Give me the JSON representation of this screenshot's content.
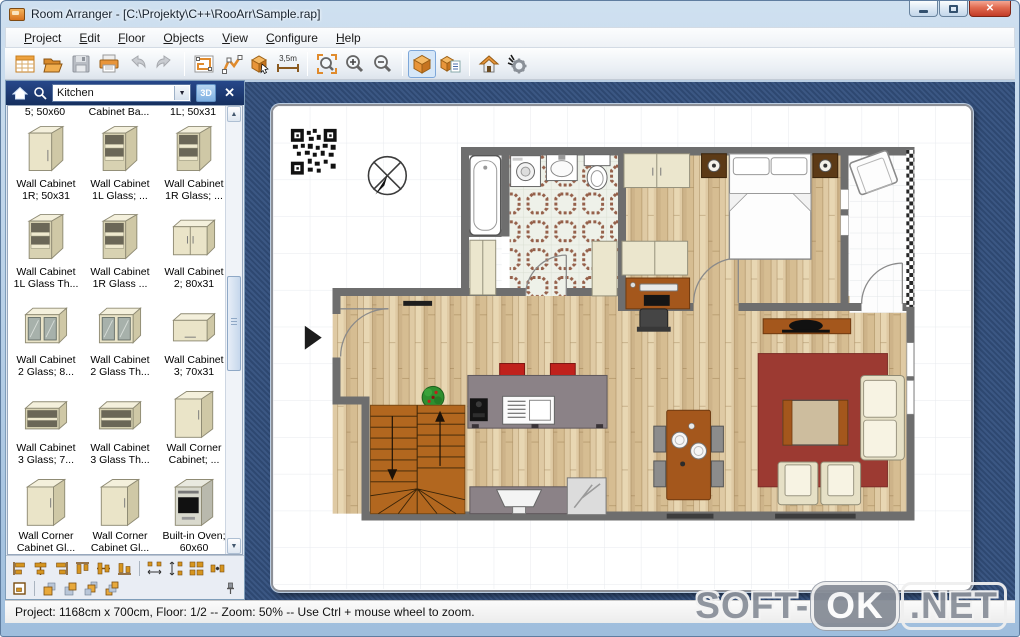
{
  "window": {
    "title": "Room Arranger - [C:\\Projekty\\C++\\RooArr\\Sample.rap]"
  },
  "menu": {
    "items": [
      "Project",
      "Edit",
      "Floor",
      "Objects",
      "View",
      "Configure",
      "Help"
    ]
  },
  "toolbar": {
    "measure_label": "3,5m",
    "buttons": [
      "new-project",
      "open",
      "save",
      "print",
      "undo",
      "redo",
      "edit-walls",
      "draw-polyline",
      "insert-object",
      "measure",
      "zoom-to-fit",
      "zoom-in",
      "zoom-out",
      "view-3d",
      "object-properties",
      "go-home",
      "preferences"
    ],
    "active_button": "view-3d"
  },
  "panel": {
    "category_value": "Kitchen",
    "view3d_label": "3D",
    "partial_row": [
      "5; 50x60",
      "Cabinet Ba...",
      "1L; 50x31"
    ],
    "items": [
      {
        "line1": "Wall Cabinet",
        "line2": "1R; 50x31"
      },
      {
        "line1": "Wall Cabinet",
        "line2": "1L Glass; ..."
      },
      {
        "line1": "Wall Cabinet",
        "line2": "1R Glass; ..."
      },
      {
        "line1": "Wall Cabinet",
        "line2": "1L Glass Th..."
      },
      {
        "line1": "Wall Cabinet",
        "line2": "1R Glass ..."
      },
      {
        "line1": "Wall Cabinet",
        "line2": "2; 80x31"
      },
      {
        "line1": "Wall Cabinet",
        "line2": "2 Glass; 8..."
      },
      {
        "line1": "Wall Cabinet",
        "line2": "2 Glass Th..."
      },
      {
        "line1": "Wall Cabinet",
        "line2": "3; 70x31"
      },
      {
        "line1": "Wall Cabinet",
        "line2": "3 Glass; 7..."
      },
      {
        "line1": "Wall Cabinet",
        "line2": "3 Glass Th..."
      },
      {
        "line1": "Wall Corner",
        "line2": "Cabinet; ..."
      },
      {
        "line1": "Wall Corner",
        "line2": "Cabinet Gl..."
      },
      {
        "line1": "Wall Corner",
        "line2": "Cabinet Gl..."
      },
      {
        "line1": "Built-in Oven;",
        "line2": "60x60"
      }
    ],
    "footer_tools_row1": [
      "align-left",
      "align-center-h",
      "align-right",
      "align-top",
      "align-center-v",
      "align-bottom",
      "space-equal-h",
      "space-equal-v",
      "same-size",
      "snap-objects"
    ],
    "footer_tools_row2": [
      "room-walls",
      "bring-to-front",
      "send-to-back",
      "bring-forward",
      "send-backward",
      "pin-panel"
    ]
  },
  "statusbar": {
    "text": "Project: 1168cm x 700cm, Floor: 1/2 -- Zoom: 50% -- Use Ctrl + mouse wheel to zoom."
  },
  "watermark": {
    "prefix": "SOFT-",
    "badge": "OK",
    "suffix": ".NET"
  },
  "colors": {
    "accent_orange": "#e08b2d",
    "panel_header_blue": "#1c3a73",
    "canvas_outer_blue": "#33507e",
    "wall_gray": "#6e6e6e",
    "rug_red": "#9c3a32",
    "stairs_brown": "#b2671f",
    "furniture_cream": "#ebe6cd",
    "furniture_brown": "#a4571c",
    "active_border": "#7da7d9"
  }
}
